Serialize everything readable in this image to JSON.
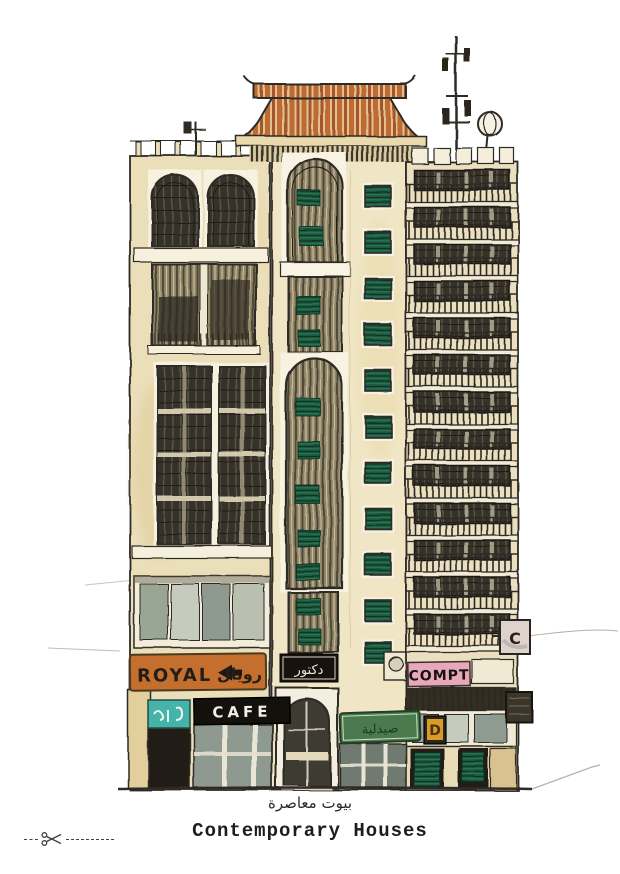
{
  "captions": {
    "arabic": "بيوت معاصرة",
    "english": "Contemporary Houses"
  },
  "signs": {
    "royal_latin": "ROYAL",
    "royal_arabic": "رويال",
    "doctor_arabic": "دكتور",
    "cafe": "CAFE",
    "compt": "COMPT",
    "pharmacy_arabic": "صيدلية",
    "d_badge": "D",
    "c_badge": "C"
  },
  "colors": {
    "facade_cream": "#ece0bb",
    "facade_center_cream": "#f0e6c5",
    "roof_terracotta": "#bf6a33",
    "shutter_green": "#1d5a41",
    "royal_orange": "#c46f2e",
    "compt_pink": "#e7a8bc",
    "teal_sign": "#45b3a7",
    "pharmacy_green": "#4a7a4d",
    "d_badge_amber": "#d99a26",
    "ink": "#2e2a25",
    "glass_sage": "#96a496",
    "pencil_grey": "#b6ab97"
  }
}
